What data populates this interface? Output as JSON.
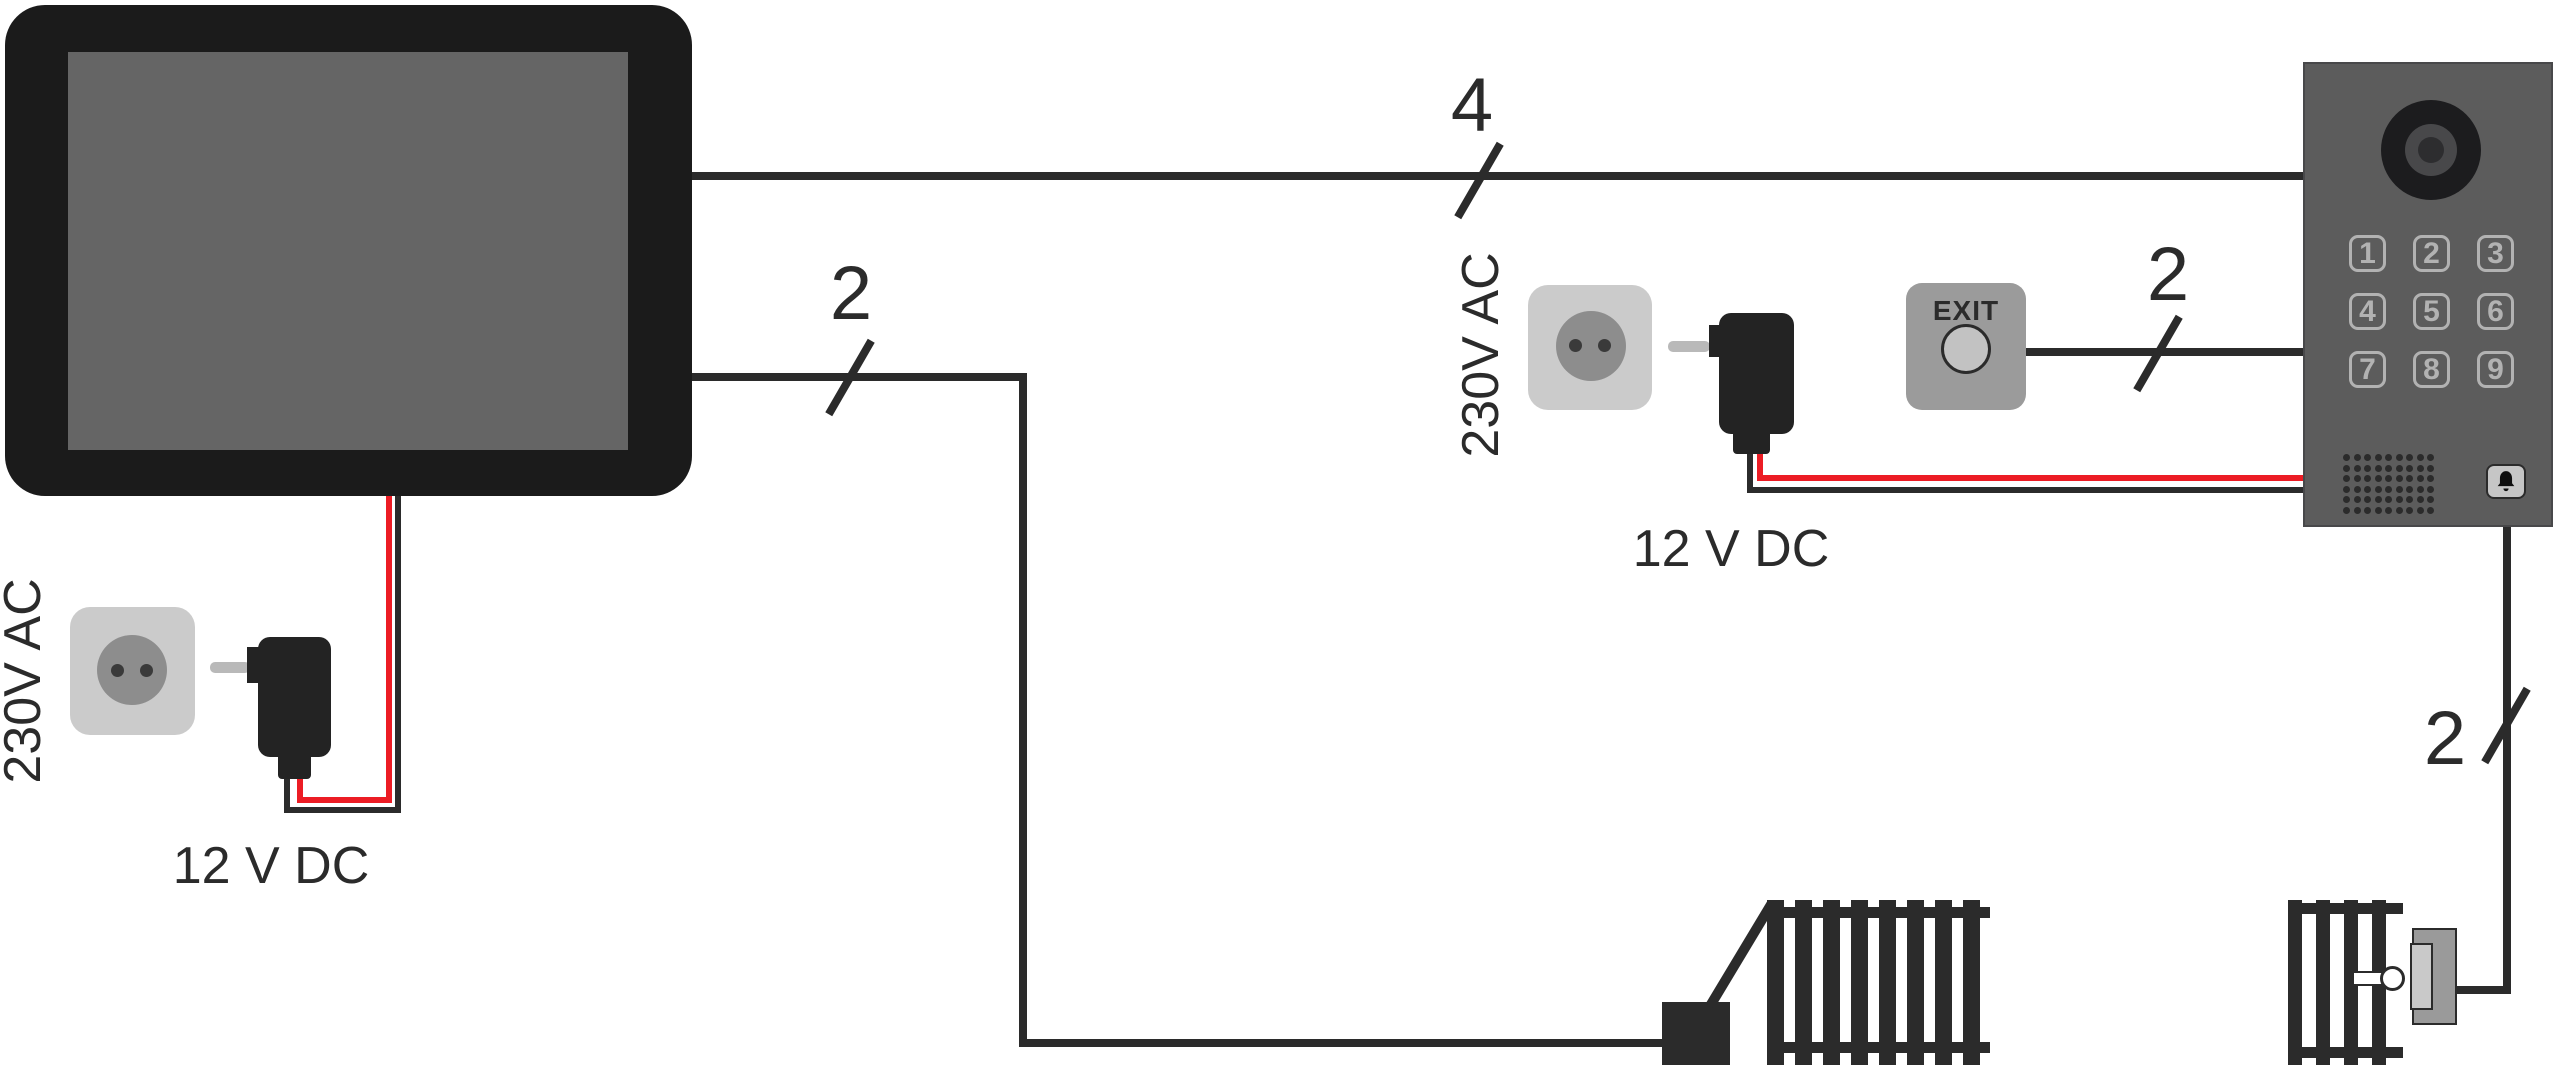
{
  "colors": {
    "background": "#ffffff",
    "wire": "#2b2b2b",
    "red_wire": "#ec1c24",
    "device_black": "#232323",
    "monitor_frame": "#1b1b1b",
    "monitor_screen": "#656565",
    "outlet_gray": "#cbcbcb",
    "socket_gray": "#8d8d8d",
    "socket_hole": "#3a3a3a",
    "prong_gray": "#b9b9b9",
    "panel_gray": "#5c5c5c",
    "panel_border": "#48484a",
    "keypad_gray": "#b2b2b2",
    "exit_body": "#9b9b9b",
    "exit_face": "#c2c2c2",
    "bell_face": "#c6c6c6",
    "plate_gray": "#9a9a9a",
    "plate_light": "#c9c9c9",
    "text": "#2b2b2b"
  },
  "labels": {
    "bus_wire_count": "4",
    "monitor_lock_wire_count": "2",
    "exit_wire_count": "2",
    "strike_wire_count": "2",
    "left_mains": "230V AC",
    "left_dc": "12 V DC",
    "middle_mains": "230V AC",
    "middle_dc": "12 V DC",
    "exit_button": "EXIT"
  },
  "door_station": {
    "keypad_keys": [
      "1",
      "2",
      "3",
      "4",
      "5",
      "6",
      "7",
      "8",
      "9"
    ],
    "speaker": {
      "rows": 6,
      "cols": 9,
      "dot_count": 54
    },
    "icons": {
      "camera": "camera-lens-icon",
      "bell": "doorbell-icon"
    }
  },
  "locks": {
    "left_bar_count": 8,
    "right_bar_count": 4
  }
}
